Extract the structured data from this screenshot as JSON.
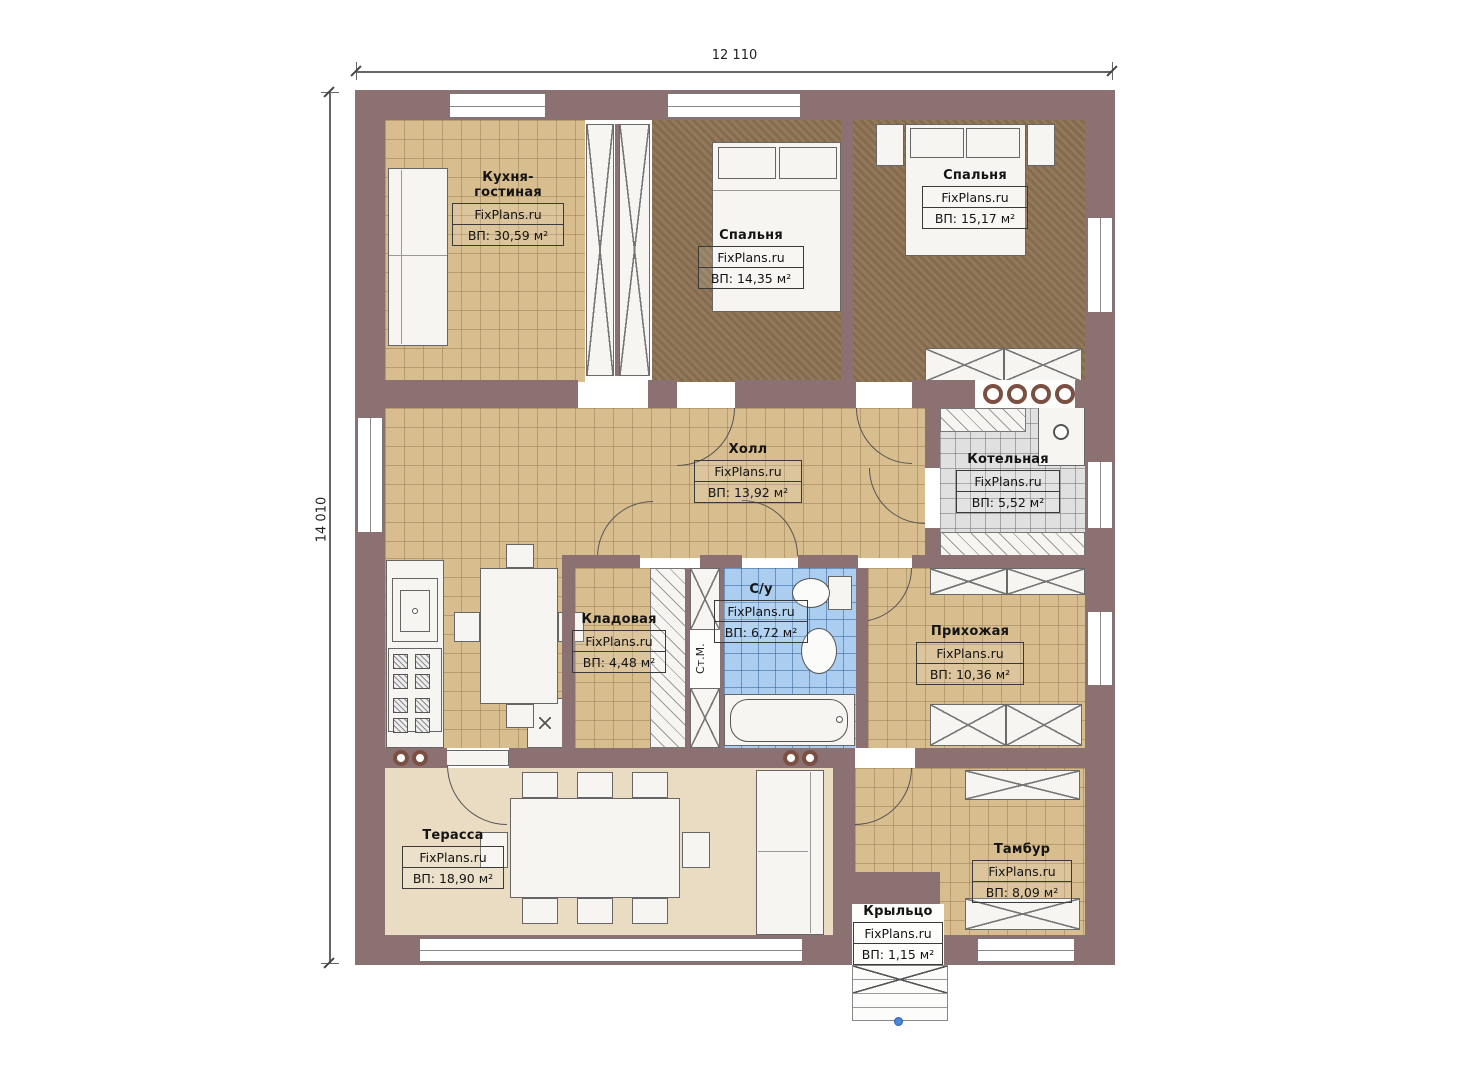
{
  "dimensions": {
    "width_label": "12 110",
    "height_label": "14 010"
  },
  "brand": "FixPlans.ru",
  "rooms": [
    {
      "name": "Кухня-гостиная",
      "brand": "FixPlans.ru",
      "area": "ВП: 30,59 м²"
    },
    {
      "name": "Спальня",
      "brand": "FixPlans.ru",
      "area": "ВП: 14,35 м²"
    },
    {
      "name": "Спальня",
      "brand": "FixPlans.ru",
      "area": "ВП: 15,17 м²"
    },
    {
      "name": "Холл",
      "brand": "FixPlans.ru",
      "area": "ВП: 13,92 м²"
    },
    {
      "name": "Котельная",
      "brand": "FixPlans.ru",
      "area": "ВП: 5,52 м²"
    },
    {
      "name": "Кладовая",
      "brand": "FixPlans.ru",
      "area": "ВП: 4,48 м²"
    },
    {
      "name": "С/у",
      "brand": "FixPlans.ru",
      "area": "ВП: 6,72 м²"
    },
    {
      "name": "Прихожая",
      "brand": "FixPlans.ru",
      "area": "ВП: 10,36 м²"
    },
    {
      "name": "Терасса",
      "brand": "FixPlans.ru",
      "area": "ВП: 18,90 м²"
    },
    {
      "name": "Тамбур",
      "brand": "FixPlans.ru",
      "area": "ВП: 8,09 м²"
    },
    {
      "name": "Крыльцо",
      "brand": "FixPlans.ru",
      "area": "ВП: 1,15 м²"
    }
  ],
  "annotations": {
    "washer": "Ст.М."
  },
  "colors": {
    "wall": "#8b7171",
    "floor_tile": "#d8bd8f",
    "floor_wood": "#8c7252",
    "floor_boiler": "#e0e0e0",
    "floor_bath": "#aacdf0",
    "floor_terrace": "#e9dcc2",
    "marker_blue": "#4a86d8"
  }
}
